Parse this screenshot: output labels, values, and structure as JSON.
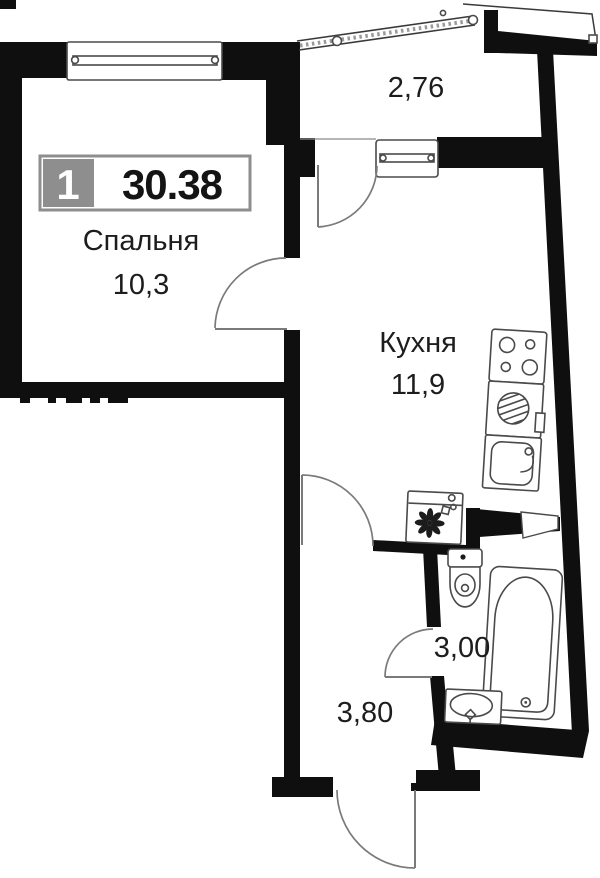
{
  "plan": {
    "badge": {
      "number": "1",
      "total_area": "30.38"
    },
    "rooms": {
      "bedroom": {
        "name": "Спальня",
        "area": "10,3"
      },
      "kitchen": {
        "name": "Кухня",
        "area": "11,9"
      },
      "balcony": {
        "area": "2,76"
      },
      "bathroom": {
        "area": "3,00"
      },
      "hallway": {
        "area": "3,80"
      }
    }
  },
  "colors": {
    "wall": "#0f0f0f",
    "fixture_outline": "#4a4a4a",
    "door_arc": "#7a7a7a",
    "badge_gray": "#8e8e8e",
    "label_text": "#1d1d1d"
  }
}
